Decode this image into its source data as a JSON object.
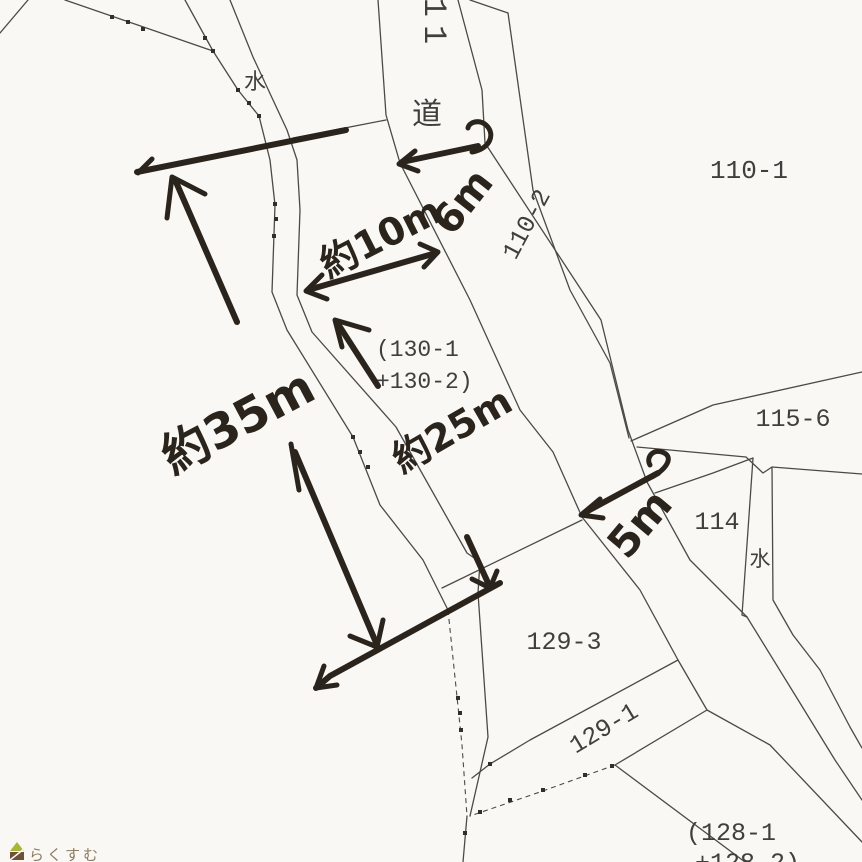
{
  "map": {
    "labels": {
      "road": "道",
      "road_number_partial": "11",
      "water_upper": "水",
      "water_lower": "水",
      "p110_1": "110-1",
      "p110_2": "110-2",
      "p115_6": "115-6",
      "p114": "114",
      "p129_3": "129-3",
      "p129_1": "129-1",
      "p128_line1": "(128-1",
      "p128_line2": "+128-2)",
      "p130_line1": "(130-1",
      "p130_line2": "+130-2)"
    },
    "annotations": {
      "road_width_top": "6m",
      "frontage_width": "約10m",
      "west_length": "約35m",
      "center_length": "約25m",
      "road_width_south": "5m"
    }
  },
  "watermark": {
    "text": "らくすむ",
    "icon": "house-icon"
  },
  "colors": {
    "paper": "#f9f8f5",
    "line": "#4a4a47",
    "label": "#3f3f3c",
    "ink": "#2a241c",
    "logo_green": "#a9b53a",
    "logo_brown": "#6e5237",
    "logo_text": "#8d7b63"
  }
}
